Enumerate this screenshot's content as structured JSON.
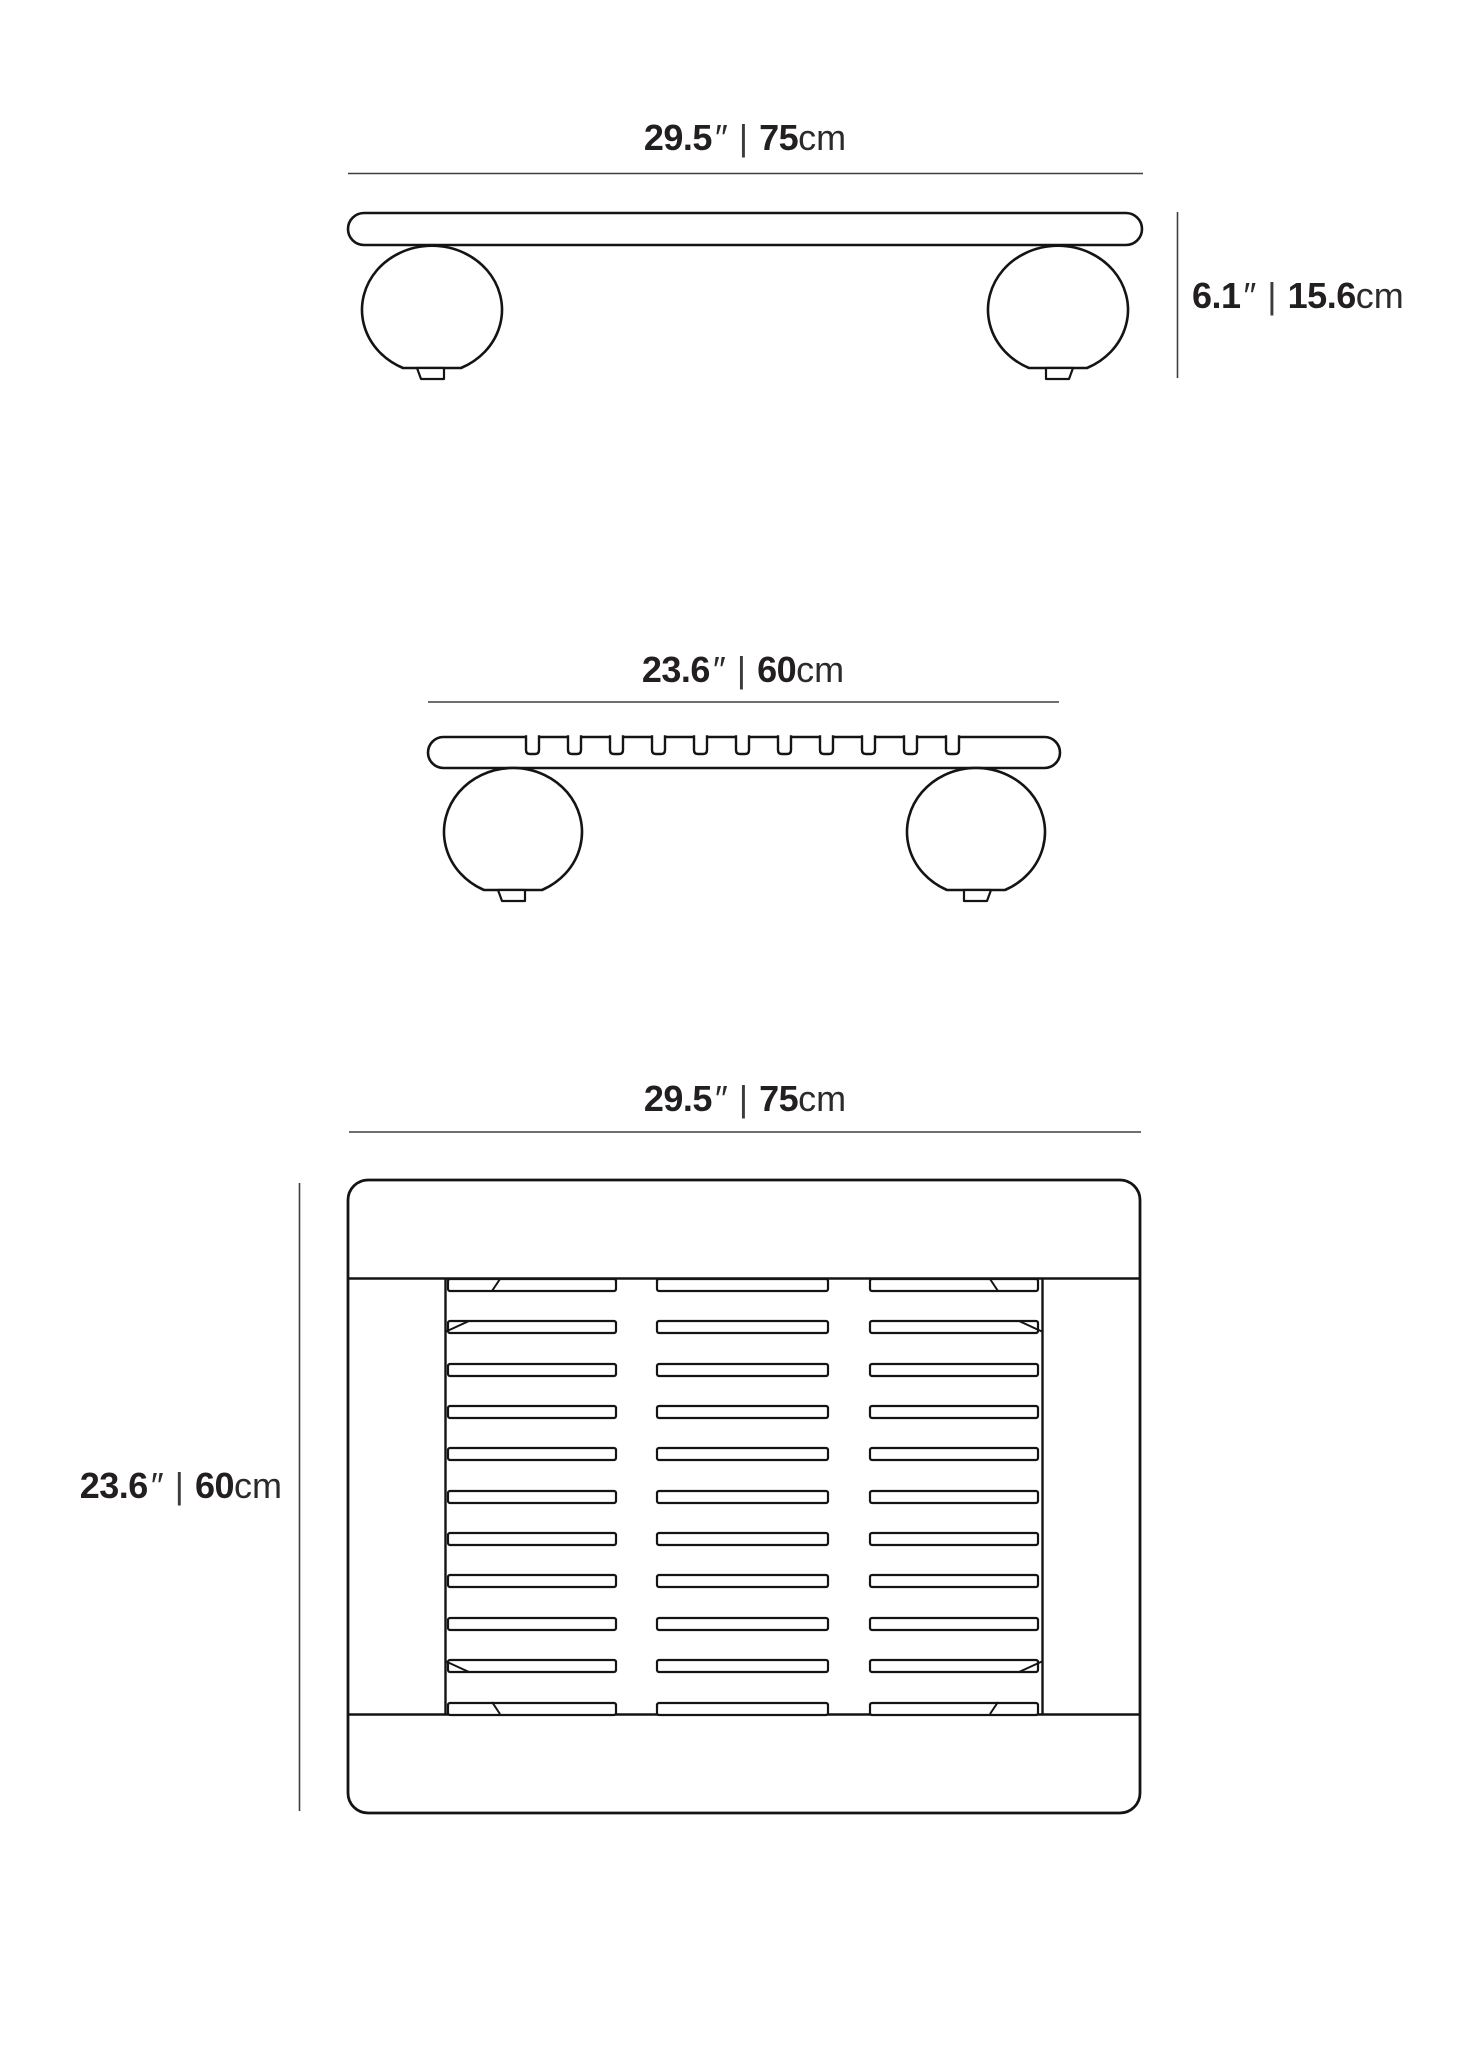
{
  "diagram": {
    "type": "furniture-dimension-drawing",
    "views": [
      "front-elevation",
      "side-elevation",
      "top-plan"
    ]
  },
  "labels": {
    "front_width": {
      "inches": "29.5",
      "inch_mark": "″",
      "separator": "|",
      "metric": "75",
      "metric_unit": "cm"
    },
    "front_height": {
      "inches": "6.1",
      "inch_mark": "″",
      "separator": "|",
      "metric": "15.6",
      "metric_unit": "cm"
    },
    "side_depth": {
      "inches": "23.6",
      "inch_mark": "″",
      "separator": "|",
      "metric": "60",
      "metric_unit": "cm"
    },
    "top_width": {
      "inches": "29.5",
      "inch_mark": "″",
      "separator": "|",
      "metric": "75",
      "metric_unit": "cm"
    },
    "top_depth": {
      "inches": "23.6",
      "inch_mark": "″",
      "separator": "|",
      "metric": "60",
      "metric_unit": "cm"
    }
  },
  "colors": {
    "drawing_line": "#141414",
    "dimension_line": "#3f3f3f",
    "text": "#231f20",
    "background": "#ffffff"
  }
}
